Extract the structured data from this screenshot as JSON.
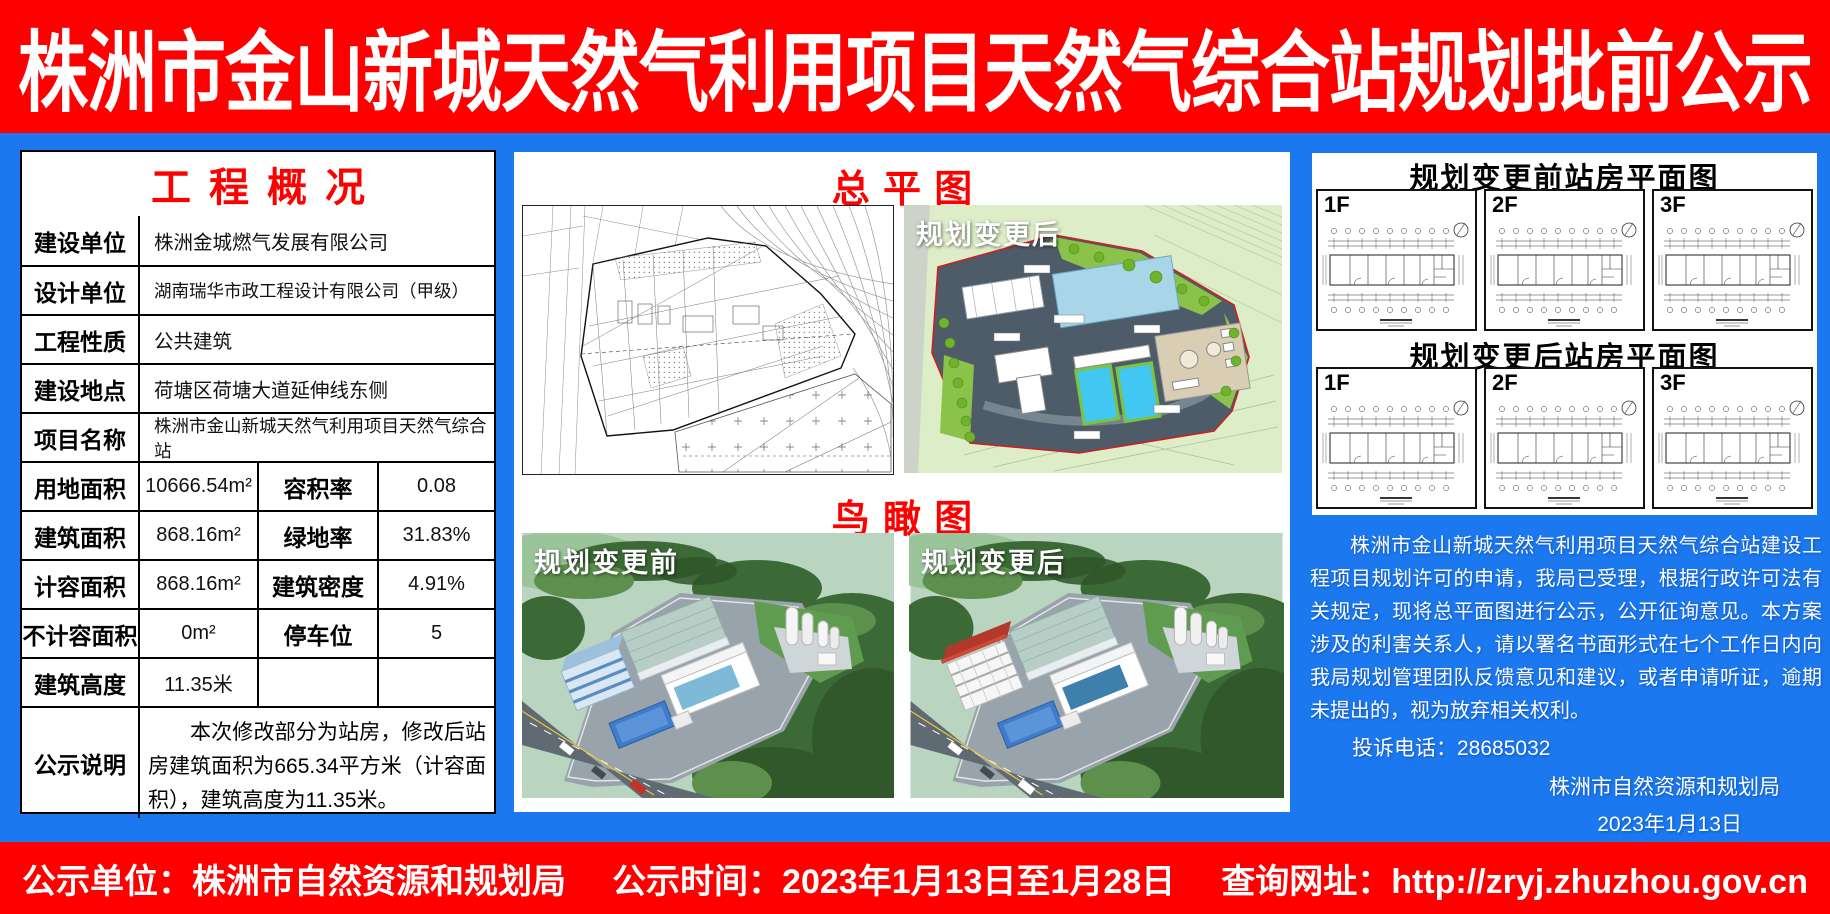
{
  "header": {
    "title": "株洲市金山新城天然气利用项目天然气综合站规划批前公示"
  },
  "colors": {
    "background_blue": "#1b78ef",
    "banner_red": "#fe0000",
    "title_red": "#ff0000",
    "pool_cyan": "#42c6f2",
    "site_slate": "#4e5c6a"
  },
  "overview": {
    "title": "工程概况",
    "rows": [
      {
        "label": "建设单位",
        "value": "株洲金城燃气发展有限公司"
      },
      {
        "label": "设计单位",
        "value": "湖南瑞华市政工程设计有限公司（甲级）"
      },
      {
        "label": "工程性质",
        "value": "公共建筑"
      },
      {
        "label": "建设地点",
        "value": "荷塘区荷塘大道延伸线东侧"
      },
      {
        "label": "项目名称",
        "value": "株洲市金山新城天然气利用项目天然气综合站"
      }
    ],
    "metrics": [
      {
        "label": "用地面积",
        "value": "10666.54m²",
        "label2": "容积率",
        "value2": "0.08"
      },
      {
        "label": "建筑面积",
        "value": "868.16m²",
        "label2": "绿地率",
        "value2": "31.83%"
      },
      {
        "label": "计容面积",
        "value": "868.16m²",
        "label2": "建筑密度",
        "value2": "4.91%"
      },
      {
        "label": "不计容面积",
        "value": "0m²",
        "label2": "停车位",
        "value2": "5"
      },
      {
        "label": "建筑高度",
        "value": "11.35米",
        "label2": "",
        "value2": ""
      }
    ],
    "note_label": "公示说明",
    "note_value": "本次修改部分为站房，修改后站房建筑面积为665.34平方米（计容面积），建筑高度为11.35米。"
  },
  "site_plan": {
    "title": "总平图",
    "after_label": "规划变更后"
  },
  "aerial": {
    "title": "鸟瞰图",
    "before_label": "规划变更前",
    "after_label": "规划变更后"
  },
  "floor_plans": {
    "before_title": "规划变更前站房平面图",
    "after_title": "规划变更后站房平面图",
    "levels": [
      "1F",
      "2F",
      "3F"
    ]
  },
  "notice": {
    "paragraph": "株洲市金山新城天然气利用项目天然气综合站建设工程项目规划许可的申请，我局已受理，根据行政许可法有关规定，现将总平面图进行公示，公开征询意见。本方案涉及的利害关系人，请以署名书面形式在七个工作日内向我局规划管理团队反馈意见和建议，或者申请听证，逾期未提出的，视为放弃相关权利。",
    "phone": "投诉电话：28685032",
    "agency": "株洲市自然资源和规划局",
    "date": "2023年1月13日"
  },
  "footer": {
    "unit": "公示单位：株洲市自然资源和规划局",
    "time": "公示时间：2023年1月13日至1月28日",
    "url": "查询网址：http://zryj.zhuzhou.gov.cn"
  }
}
